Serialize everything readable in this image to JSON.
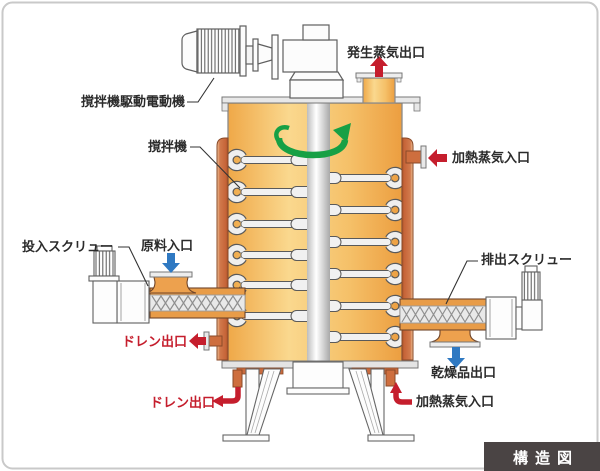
{
  "diagram": {
    "title_badge": "構造図",
    "labels": {
      "motor": "撹拌機駆動電動機",
      "agitator": "撹拌機",
      "steam_out": "発生蒸気出口",
      "steam_in_side": "加熱蒸気入口",
      "feed_screw": "投入スクリュー",
      "material_in": "原料入口",
      "drain_mid": "ドレン出口",
      "drain_bottom": "ドレン出口",
      "discharge_screw": "排出スクリュー",
      "product_out": "乾燥品出口",
      "steam_in_bottom": "加熱蒸気入口"
    },
    "icons": {
      "rotation_arrow": "green-rotation-arrow",
      "steam_arrows": "red-arrow",
      "material_arrows": "blue-arrow"
    },
    "colors": {
      "vessel_light": "#fad88e",
      "vessel_dark": "#ec9e40",
      "jacket": "#cc6b40",
      "arrow_red": "#c51e2d",
      "arrow_blue": "#2f79c2",
      "arrow_green": "#17a045",
      "badge_bg": "#4a4444",
      "outline": "#5f5f5f",
      "page_border": "#c9c9c9"
    }
  }
}
